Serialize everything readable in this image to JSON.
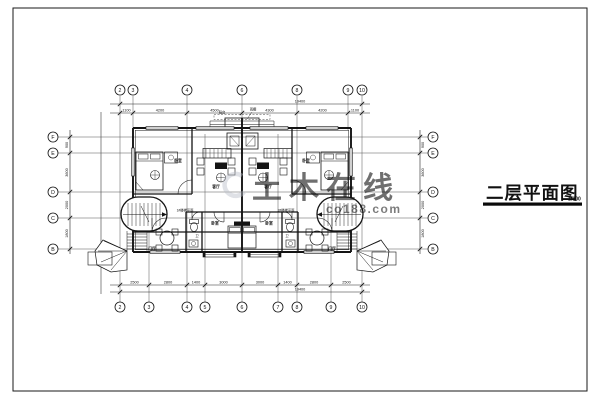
{
  "title_block": {
    "title": "二层平面图",
    "scale": "1:100"
  },
  "watermark": {
    "brand": "土木在线",
    "domain": "co188.com"
  },
  "axes": {
    "top": [
      "2",
      "3",
      "4",
      "6",
      "8",
      "9",
      "10"
    ],
    "bottom": [
      "2",
      "3",
      "4",
      "5",
      "6",
      "7",
      "8",
      "9",
      "10"
    ],
    "left": [
      "F",
      "E",
      "D",
      "C",
      "B"
    ],
    "right": [
      "F",
      "E",
      "D",
      "C",
      "B"
    ]
  },
  "dims": {
    "top_overall": "19400",
    "top_segments": [
      "1100",
      "4200",
      "4500",
      "4300",
      "4200",
      "1100"
    ],
    "bottom_overall": "19400",
    "bottom_segments": [
      "2500",
      "2800",
      "1400",
      "3000",
      "3000",
      "1400",
      "2800",
      "2500"
    ],
    "left_segments": [
      "900",
      "3600",
      "2000",
      "1800"
    ],
    "right_segments": [
      "900",
      "3600",
      "2000",
      "1800"
    ]
  },
  "rooms": {
    "bedroom": "卧室",
    "living": "客厅",
    "hall": "门厅",
    "bath": "卫",
    "balcony": "阳台",
    "canopy": "雨棚"
  },
  "stairs": {
    "left": "1#楼梯平面",
    "right": "2#楼梯平面"
  },
  "colors": {
    "ink": "#141414",
    "grid": "#555555",
    "watermark": "#b7bdc8"
  }
}
